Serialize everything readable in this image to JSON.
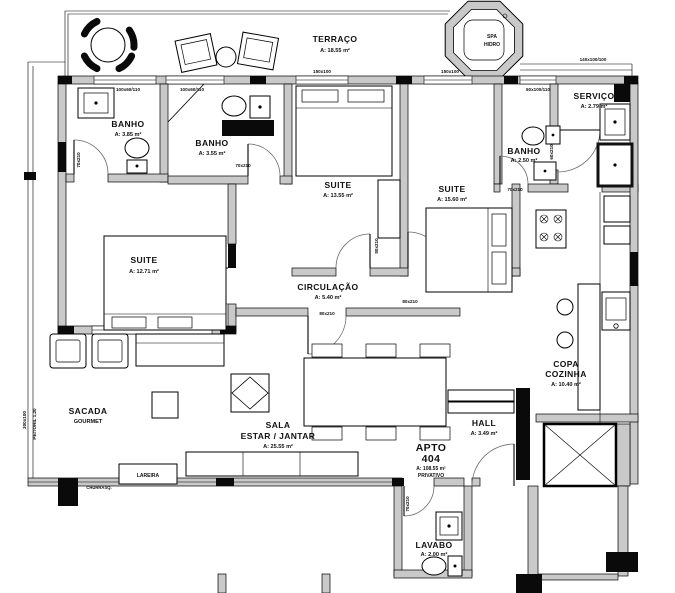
{
  "colors": {
    "background": "#ffffff",
    "wall_fill": "#c9c9c9",
    "line": "#000000",
    "black_fill": "#0a0a0a"
  },
  "rooms": [
    {
      "name": "TERRAÇO",
      "area": "A: 18.55 m²"
    },
    {
      "name": "SPA",
      "sub": "HIDRO"
    },
    {
      "name": "BANHO",
      "area": "A: 3.85 m²"
    },
    {
      "name": "BANHO",
      "area": "A: 3.55 m²"
    },
    {
      "name": "BANHO",
      "area": "A: 2.50 m²"
    },
    {
      "name": "SERVIÇO",
      "area": "A: 2.79 m²"
    },
    {
      "name": "SUITE",
      "area": "A: 12.71 m²"
    },
    {
      "name": "SUITE",
      "area": "A: 13.55 m²"
    },
    {
      "name": "SUITE",
      "area": "A: 15.60 m²"
    },
    {
      "name": "CIRCULAÇÃO",
      "area": "A: 5.40 m²"
    },
    {
      "name": "SACADA",
      "sub": "GOURMET"
    },
    {
      "name": "SALA",
      "sub": "ESTAR / JANTAR",
      "area": "A: 25.55 m²"
    },
    {
      "name": "COPA",
      "sub": "COZINHA",
      "area": "A: 10.40 m²"
    },
    {
      "name": "HALL",
      "area": "A: 3.49 m²"
    },
    {
      "name": "LAVABO",
      "area": "A: 2.00 m²"
    }
  ],
  "apartment": {
    "label": "APTO",
    "number": "404",
    "area": "A: 108.55 m²",
    "note": "PRIVATIVO"
  },
  "features": {
    "lareira": "LAREIRA",
    "churrasqueira": "CHURRASQ."
  },
  "dims": [
    "150x100",
    "150x100",
    "100x60/110",
    "100x60/110",
    "60x100/110",
    "140x100/100",
    "70x210",
    "70x210",
    "70x210",
    "60x210",
    "80x210",
    "80x210",
    "80x210",
    "70x210",
    "300x100",
    "PEITORIL 1,20"
  ]
}
